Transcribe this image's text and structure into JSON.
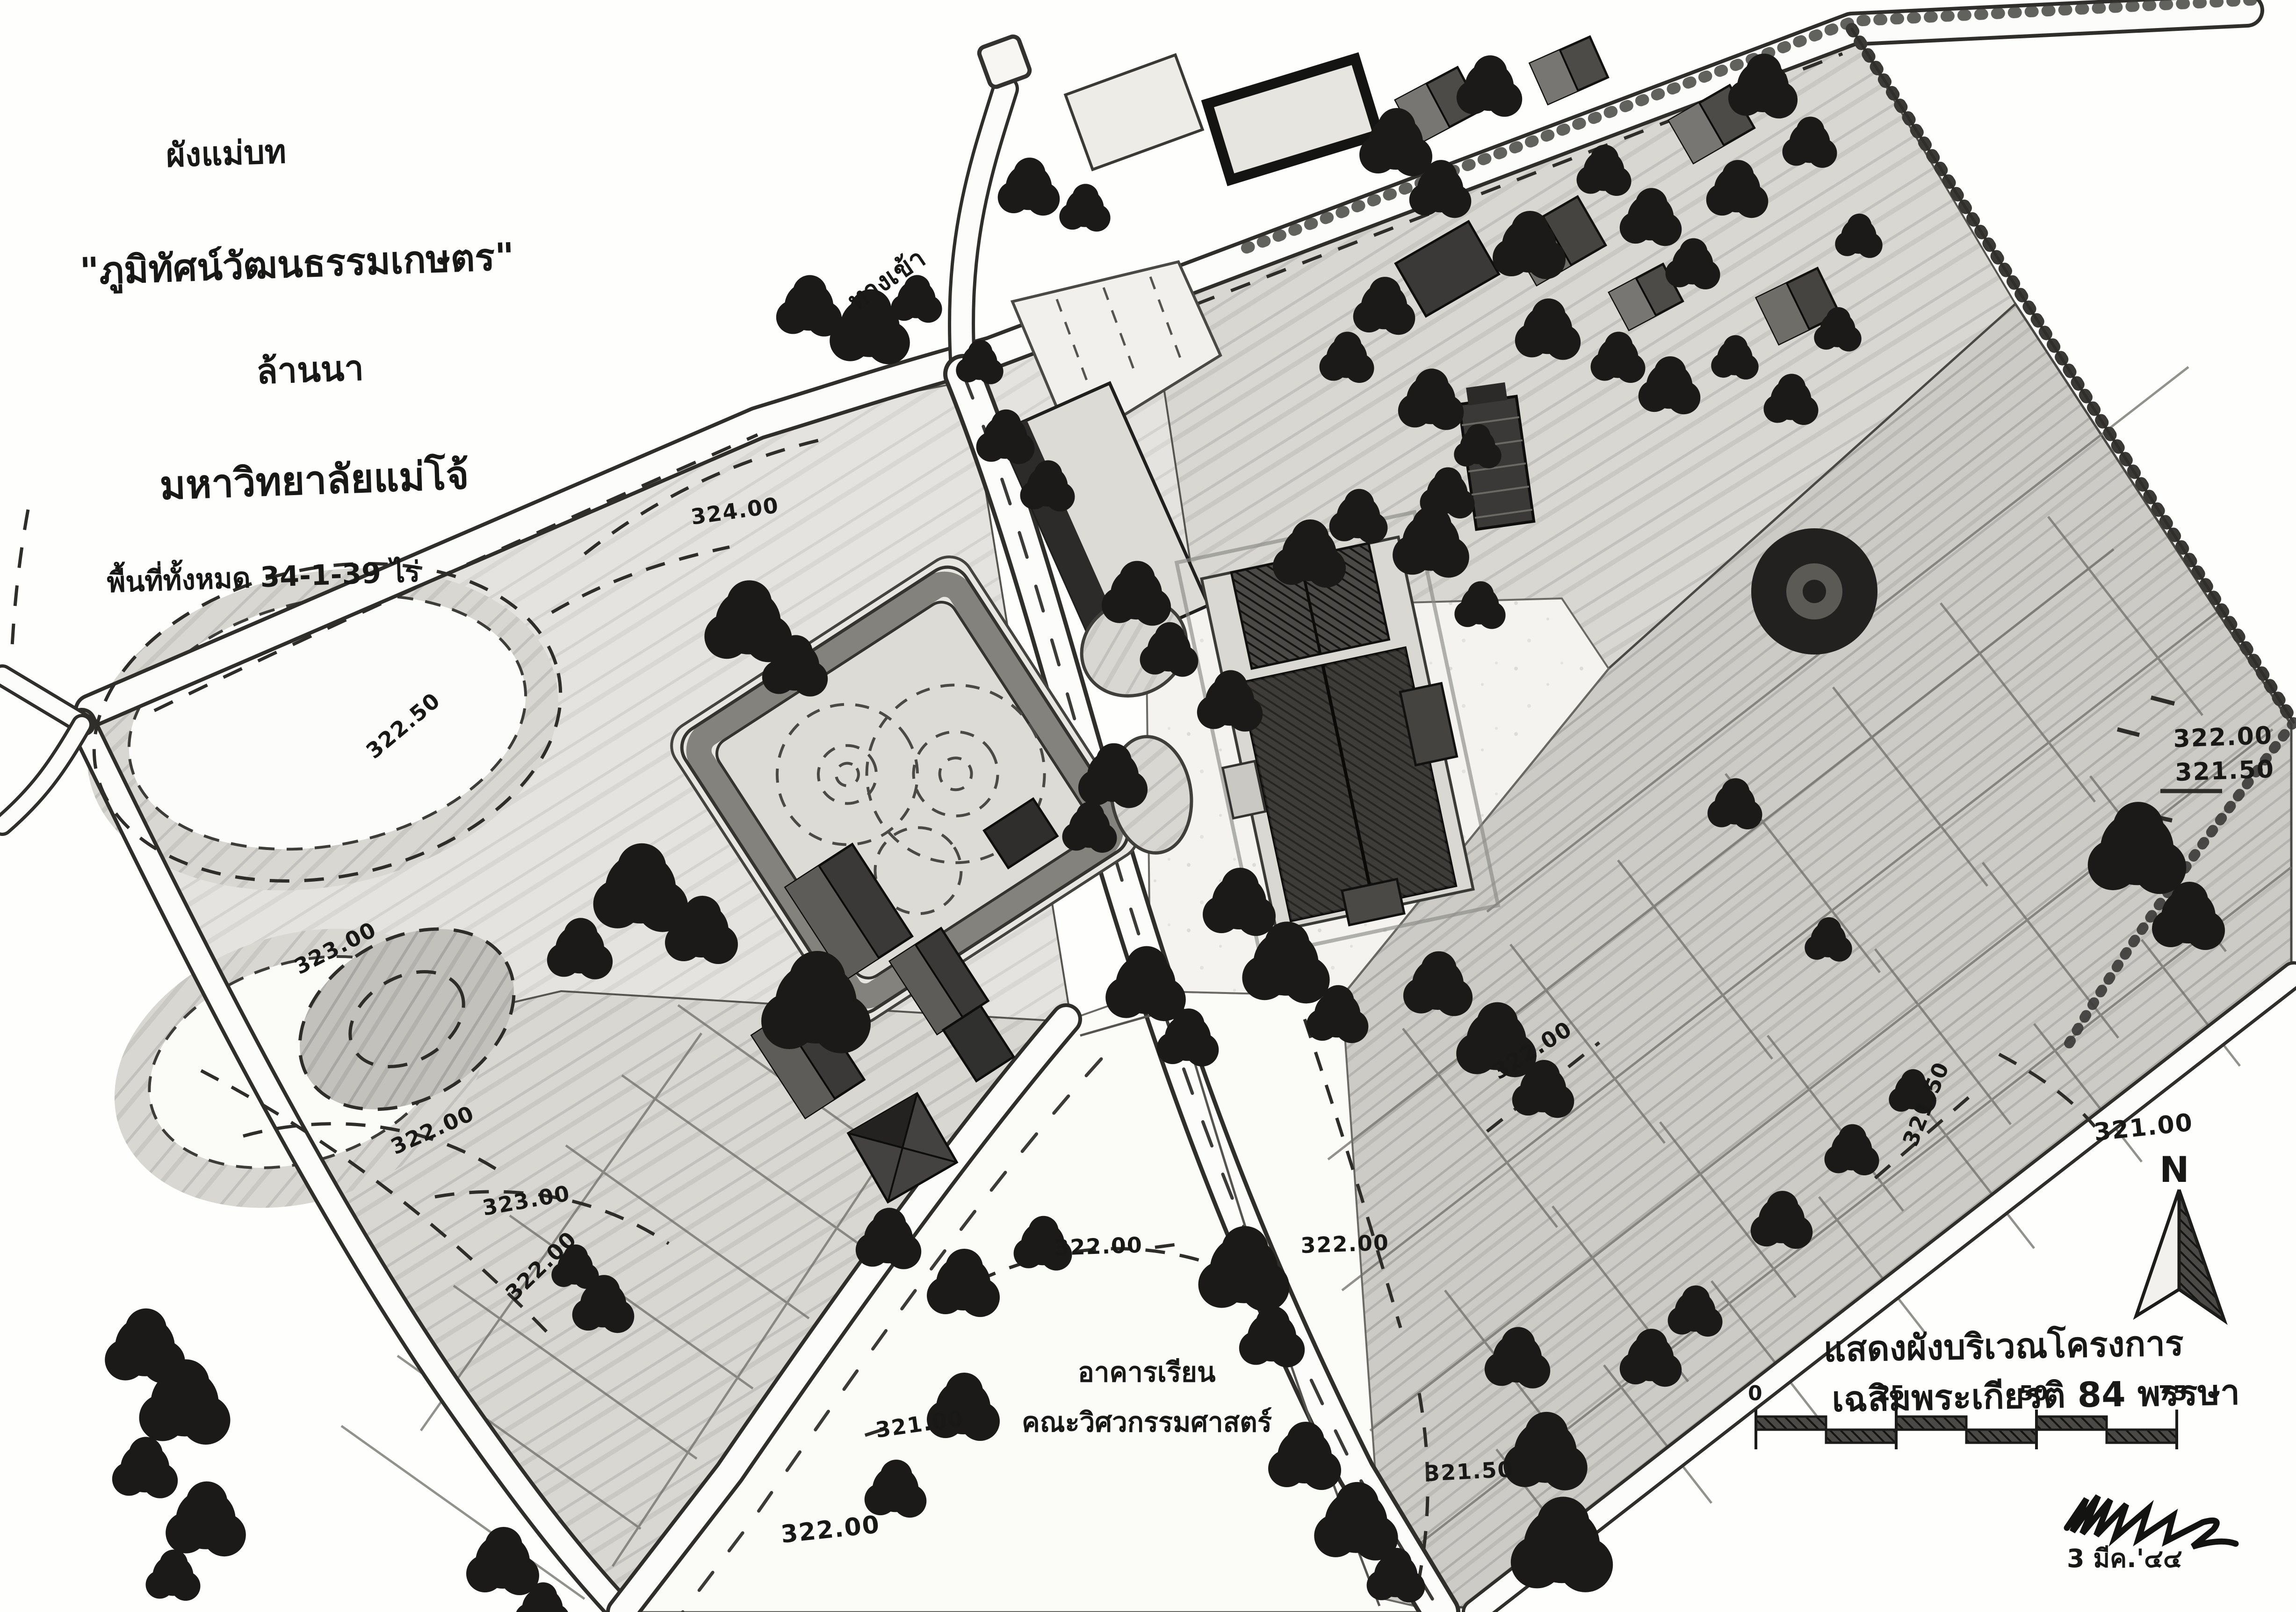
{
  "document": {
    "kind": "hand-drawn landscape master plan",
    "title": {
      "line1": "ผังแม่บท",
      "line2": "\"ภูมิทัศน์วัฒนธรรมเกษตร\"",
      "line3": "ล้านนา",
      "line4": "มหาวิทยาลัยแม่โจ้",
      "line5": "พื้นที่ทั้งหมด 34-1-39 ไร่"
    },
    "entrance_label": "ทางเข้า",
    "building_label": {
      "line1": "อาคารเรียน",
      "line2": "คณะวิศวกรรมศาสตร์"
    },
    "caption": {
      "line1": "แสดงผังบริเวณโครงการ",
      "line2": "เฉลิมพระเกียรติ 84 พรรษา"
    },
    "date_note": "3 มีค.'๔๔",
    "north_label": "N",
    "scale_bar": {
      "ticks": [
        "0",
        "25",
        "50",
        "75"
      ]
    },
    "contours": [
      "324.00",
      "322.50",
      "323.00",
      "322.00",
      "323.00",
      "322.00",
      "321.00",
      "322.00",
      "322.00",
      "322.00",
      "321.50",
      "322.00",
      "321.50",
      "321.00",
      "322.00",
      "321.50"
    ]
  },
  "colors": {
    "paper": "#fefefc",
    "ink": "#181816",
    "field_light": "#e4e3df",
    "field_mid": "#d8d7d2",
    "paddy": "#cccbc6",
    "tree": "#1b1a18",
    "building_dark": "#33322f",
    "road": "#fcfcfa"
  }
}
